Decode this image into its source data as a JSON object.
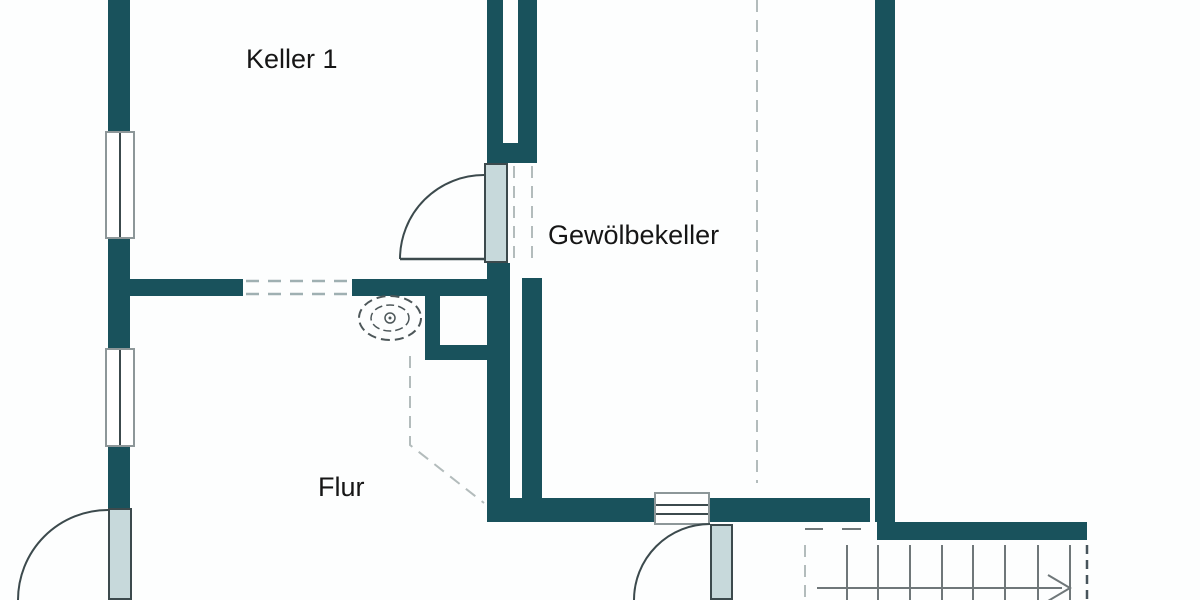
{
  "drawing_title": "Kellergeschoss Grundriss",
  "rooms": {
    "keller1": {
      "label": "Keller 1"
    },
    "gewoelbekeller": {
      "label": "Gewölbekeller"
    },
    "flur": {
      "label": "Flur"
    }
  },
  "colors": {
    "wall": "#19525c",
    "leaf": "#c7d9db",
    "frame": "#8d9799",
    "line": "#3c4a4d",
    "dash": "#b3bcbc",
    "dashdark": "#47545b",
    "stair": "#6f7779",
    "text": "#161616",
    "bg": "#fdfefe"
  },
  "symbols": {
    "door_swing": "quarter-circle-arc",
    "window": "rect-with-mullion-lines",
    "stairs": "parallel-tread-lines-with-direction-arrow",
    "vault_boundary": "dashed-line",
    "basin": "nested-dashed-ovals-with-drain-circle"
  }
}
